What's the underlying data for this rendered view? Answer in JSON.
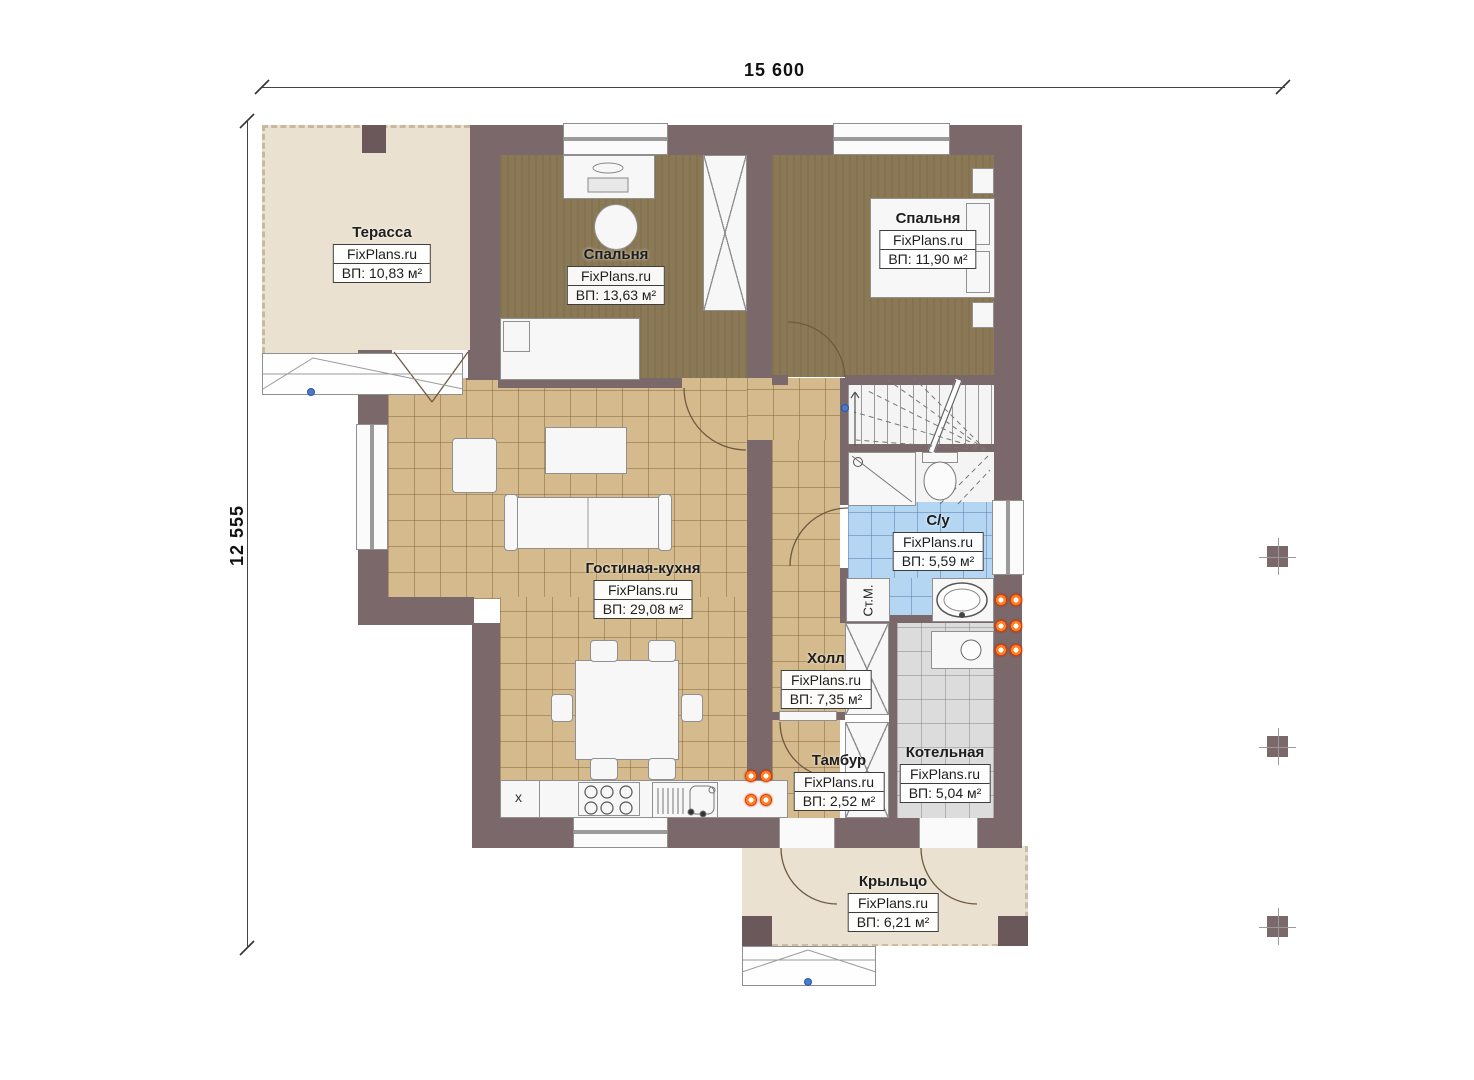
{
  "dimensions": {
    "width_label": "15 600",
    "height_label": "12 555"
  },
  "rooms": [
    {
      "key": "terrace",
      "name": "Терасса",
      "brand": "FixPlans.ru",
      "area": "ВП: 10,83 м²"
    },
    {
      "key": "bedroom1",
      "name": "Спальня",
      "brand": "FixPlans.ru",
      "area": "ВП: 13,63 м²"
    },
    {
      "key": "bedroom2",
      "name": "Спальня",
      "brand": "FixPlans.ru",
      "area": "ВП: 11,90 м²"
    },
    {
      "key": "living",
      "name": "Гостиная-кухня",
      "brand": "FixPlans.ru",
      "area": "ВП: 29,08 м²"
    },
    {
      "key": "bathroom",
      "name": "С/у",
      "brand": "FixPlans.ru",
      "area": "ВП: 5,59 м²"
    },
    {
      "key": "hall",
      "name": "Холл",
      "brand": "FixPlans.ru",
      "area": "ВП: 7,35 м²"
    },
    {
      "key": "vestibule",
      "name": "Тамбур",
      "brand": "FixPlans.ru",
      "area": "ВП: 2,52 м²"
    },
    {
      "key": "boiler",
      "name": "Котельная",
      "brand": "FixPlans.ru",
      "area": "ВП: 5,04 м²"
    },
    {
      "key": "porch",
      "name": "Крыльцо",
      "brand": "FixPlans.ru",
      "area": "ВП: 6,21 м²"
    }
  ],
  "fixtures": {
    "washing_machine": "Ст.М.",
    "kitchen_cabinet_mark": "x"
  },
  "colors": {
    "wall": "#7b686b",
    "wall_dark": "#6b585b",
    "wood_floor": "#8b7956",
    "tile_tan": "#d4ba8c",
    "tile_blue": "#b5d6f3",
    "tile_gray": "#dcdcdc",
    "deck": "#eae1d0",
    "radiator": "#e23b00",
    "marker": "#4a79c9"
  }
}
